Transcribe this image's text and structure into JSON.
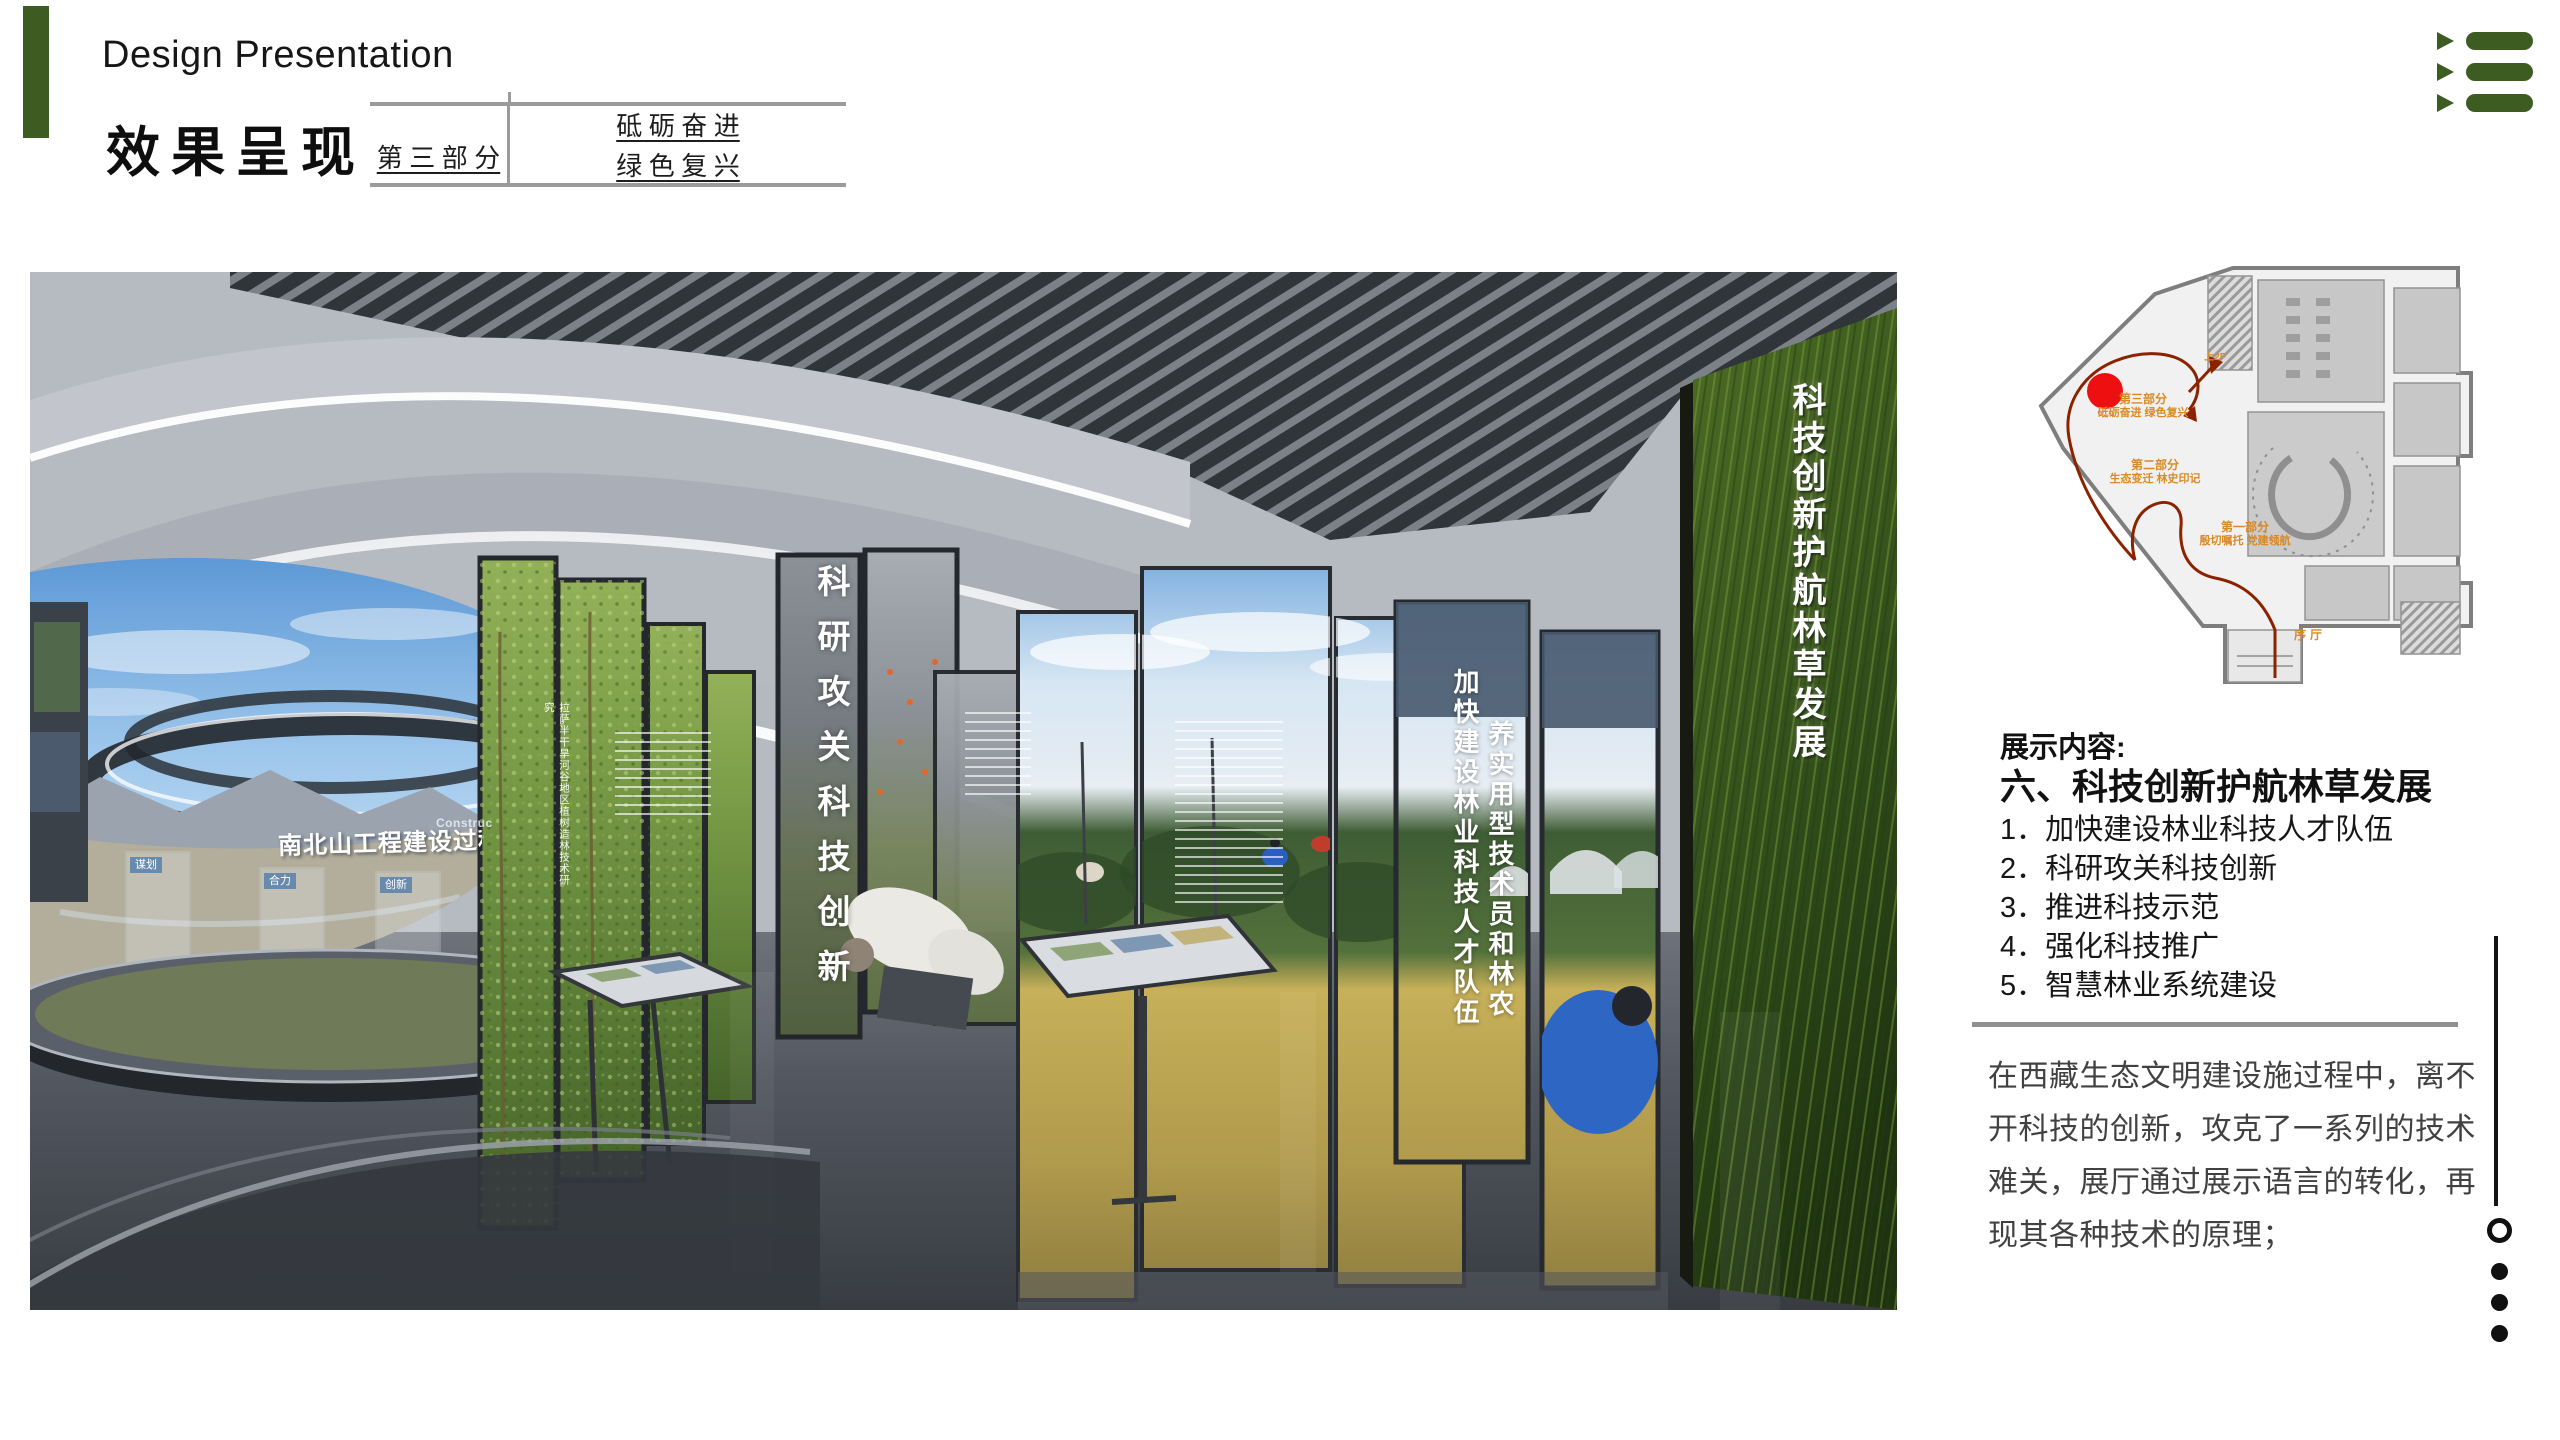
{
  "header": {
    "title_en": "Design Presentation",
    "title_zh": "效果呈现",
    "part": {
      "label": "第 三 部 分",
      "name_line1": "砥 砺 奋 进",
      "name_line2": "绿 色 复 兴"
    },
    "accent_color": "#3d5c22"
  },
  "main_render": {
    "screen_title": "南北山工程建设过程",
    "screen_caption_en": "Construc",
    "glass_labels": [
      "谋划",
      "合力",
      "创新"
    ],
    "panel_labels": {
      "sapling_study": "拉萨半干旱河谷地区植树造林技术研究",
      "research": "科研攻关科技创新",
      "talent": "加快建设林业科技人才队伍",
      "practical": "养实用型技术员和林农",
      "headline": "科技创新护航林草发展"
    }
  },
  "floor_plan": {
    "labels": {
      "part3_line1": "第三部分",
      "part3_line2": "砥砺奋进 绿色复兴",
      "part2_line1": "第二部分",
      "part2_line2": "生态变迁 林史印记",
      "part1_line1": "第一部分",
      "part1_line2": "殷切嘱托 党建领航",
      "lobby": "序厅",
      "to_2f": "上2F"
    },
    "marker_color": "#ee1010",
    "route_color": "#8b2300",
    "label_color": "#d98a25"
  },
  "content_panel": {
    "heading": "展示内容:",
    "section_title": "六、科技创新护航林草发展",
    "items": [
      "1．加快建设林业科技人才队伍",
      "2．科研攻关科技创新",
      "3．推进科技示范",
      "4．强化科技推广",
      "5．智慧林业系统建设"
    ],
    "paragraph": "在西藏生态文明建设施过程中，离不开科技的创新，攻克了一系列的技术难关，展厅通过展示语言的转化，再现其各种技术的原理；"
  }
}
